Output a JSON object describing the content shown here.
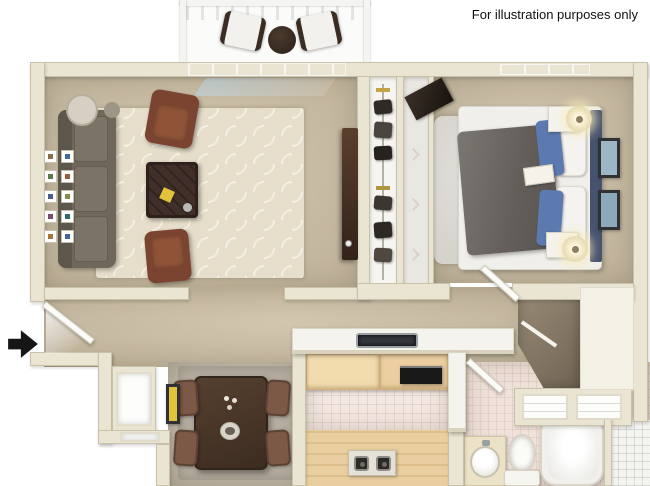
{
  "disclaimer": "For illustration purposes only",
  "icons": {
    "entry_arrow": "right-arrow"
  },
  "colors": {
    "wall": "#eae5d2",
    "floorTan": "#d2c6ae",
    "floorTanDark": "#beb199",
    "rug": "#e6ddca",
    "rugPattern": "#f4efe3",
    "sofa": "#6f675a",
    "leather": "#7b4430",
    "woodDark": "#41302a",
    "shag": "#d6d3cd",
    "duvet": "#645f5b",
    "pillowBlue": "#5d7ab0",
    "headboard": "#46536e",
    "glass": "#c3d7e4",
    "counter": "#f5f3ed",
    "cabinetWood": "#eccfa0",
    "floorWood": "#e9cf9f",
    "tileKitchen": "#f4e8e2",
    "tileBath": "#f0e2da",
    "tileWhite": "#f4f4f1",
    "closetDark": "#6f6353",
    "chairBrown": "#7c5847",
    "artYellow": "#e2c23a",
    "artBlue": "#9db6c6",
    "black": "#161616"
  }
}
